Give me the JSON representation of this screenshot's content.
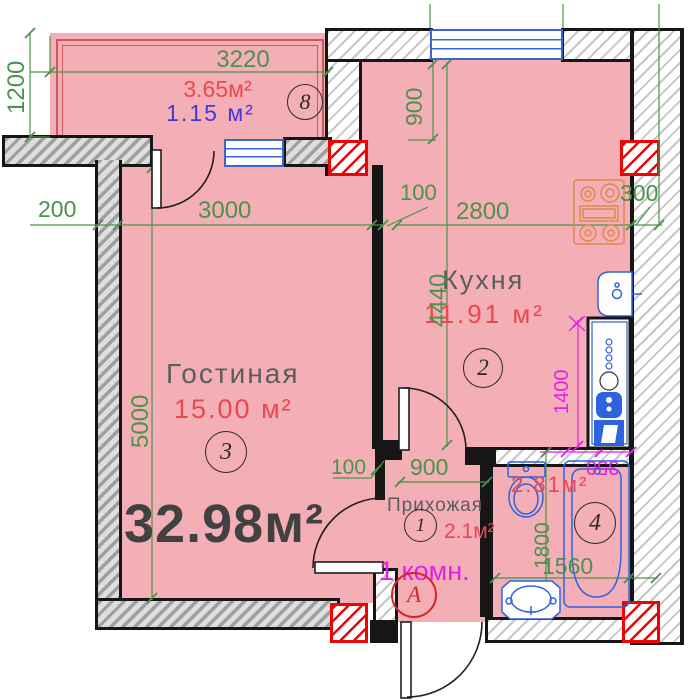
{
  "summary": {
    "total_area": "32.98м²",
    "apartment_type": "1 комн.",
    "section_letter": "А"
  },
  "rooms": {
    "balcony": {
      "number": "8",
      "area": "3.65м²",
      "area_secondary": "1.15 м²"
    },
    "kitchen": {
      "label": "Кухня",
      "number": "2",
      "area": "11.91 м²"
    },
    "living_room": {
      "label": "Гостиная",
      "number": "3",
      "area": "15.00 м²"
    },
    "hallway": {
      "label": "Прихожая",
      "number": "1",
      "area": "2.1м²"
    },
    "bathroom": {
      "number": "4",
      "area": "2.81м²"
    }
  },
  "dimensions_mm": {
    "balcony_width": "3220",
    "balcony_depth": "1200",
    "left_wall_offset": "200",
    "living_width": "3000",
    "partition_thickness": "100",
    "kitchen_width": "2800",
    "right_wall_thickness": "300",
    "kitchen_window_offset": "900",
    "kitchen_depth": "4440",
    "appliance_zone": "1400",
    "living_depth": "5000",
    "hall_partition_thickness": "100",
    "hall_width": "900",
    "bathroom_depth": "1800",
    "bathroom_width": "1560",
    "tub_offset": "350"
  },
  "colors": {
    "floor_pink": "#f4aeb6",
    "dimension_green": "#4a934a",
    "dimension_magenta": "#e51fe5",
    "area_red": "#e8484e",
    "area_blue": "#4636e0",
    "window_blue": "#3a66cc",
    "fixture_blue": "#2f62dd",
    "column_red": "#ea0606"
  }
}
